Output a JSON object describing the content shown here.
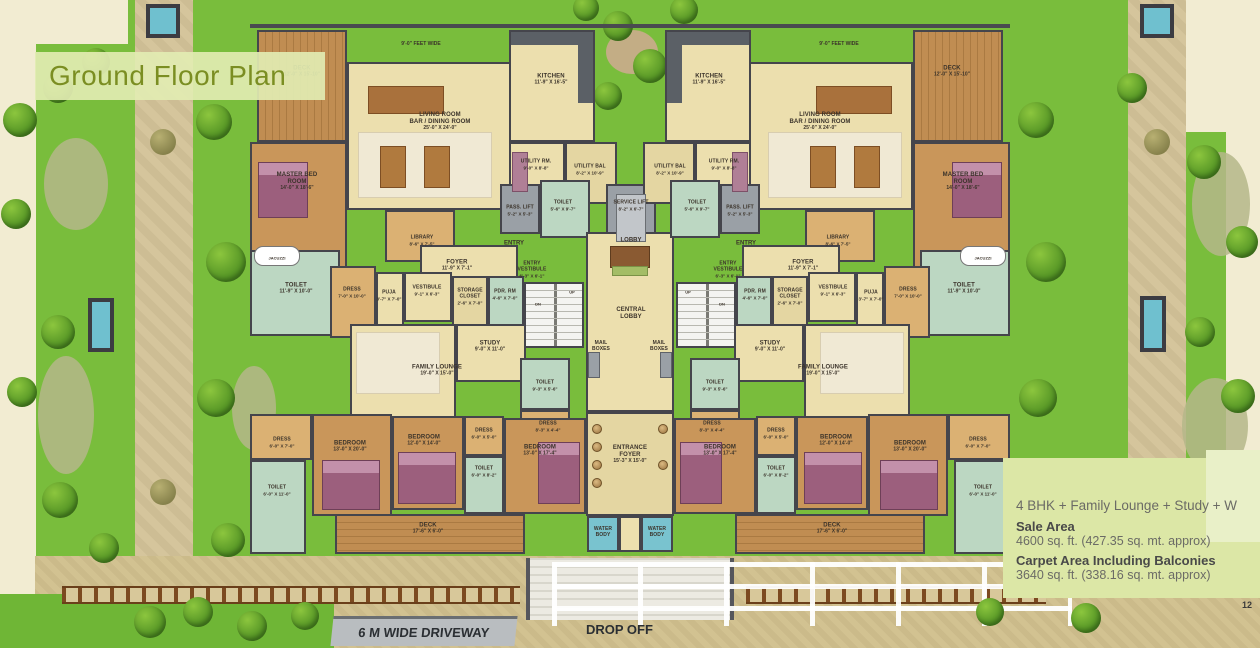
{
  "title": "Ground Floor Plan",
  "page_number": "12",
  "site": {
    "driveway": "6 M WIDE DRIVEWAY",
    "drop_off": "DROP OFF",
    "feet_wide": "9'-0\" FEET WIDE"
  },
  "info": {
    "configuration": "4 BHK + Family Lounge + Study + W",
    "sale_area_label": "Sale Area",
    "sale_area_value": "4600 sq. ft. (427.35 sq. mt. approx)",
    "carpet_area_label": "Carpet Area Including Balconies",
    "carpet_area_value": "3640 sq. ft. (338.16 sq. mt. approx)"
  },
  "rooms": {
    "kitchen": {
      "name": "KITCHEN",
      "dims": "11'-9\" X 16'-5\""
    },
    "living": {
      "line1": "LIVING ROOM",
      "line2": "BAR / DINING ROOM",
      "dims": "25'-0\" X 24'-0\""
    },
    "deck_top": {
      "name": "DECK",
      "dims": "12'-0\" X 15'-10\""
    },
    "deck_bottom": {
      "name": "DECK",
      "dims": "17'-6\" X 6'-0\""
    },
    "utility_rm": {
      "name": "UTILITY RM.",
      "dims": "9'-0\" X 8'-8\""
    },
    "utility_bal": {
      "name": "UTILITY BAL",
      "dims": "8'-2\" X 10'-9\""
    },
    "pass_lift": {
      "name": "PASS. LIFT",
      "dims": "5'-2\" X 5'-3\""
    },
    "service_lift": {
      "name": "SERVICE LIFT",
      "dims": "8'-2\" X 6'-7\""
    },
    "toilet_lift": {
      "name": "TOILET",
      "dims": "5'-6\" X 9'-7\""
    },
    "master_bed": {
      "line1": "MASTER BED",
      "line2": "ROOM",
      "dims": "14'-0\" X 18'-6\""
    },
    "library": {
      "name": "LIBRARY",
      "dims": "8'-6\" X 7'-5\""
    },
    "foyer": {
      "name": "FOYER",
      "dims": "11'-9\" X 7'-1\""
    },
    "entry_vestibule": {
      "line1": "ENTRY",
      "line2": "VESTIBULE",
      "dims": "6'-3\" X 6'-1\""
    },
    "entry": "ENTRY",
    "lobby": "LOBBY",
    "central_lobby": {
      "line1": "CENTRAL",
      "line2": "LOBBY"
    },
    "mail_boxes": {
      "line1": "MAIL",
      "line2": "BOXES"
    },
    "toilet_master": {
      "name": "TOILET",
      "dims": "11'-9\" X 10'-0\""
    },
    "dress_master": {
      "name": "DRESS",
      "dims": "7'-0\" X 10'-0\""
    },
    "puja": {
      "name": "PUJA",
      "dims": "3'-7\" X 7'-0\""
    },
    "vestibule": {
      "name": "VESTIBULE",
      "dims": "9'-1\" X 6'-3\""
    },
    "storage_closet": {
      "line1": "STORAGE",
      "line2": "CLOSET",
      "dims": "2'-6\" X 7'-0\""
    },
    "pdr_rm": {
      "name": "PDR. RM",
      "dims": "4'-6\" X 7'-0\""
    },
    "study": {
      "name": "STUDY",
      "dims": "9'-0\" X 11'-0\""
    },
    "family_lounge": {
      "name": "FAMILY LOUNGE",
      "dims": "19'-0\" X 15'-0\""
    },
    "toilet_family": {
      "name": "TOILET",
      "dims": "9'-3\" X 5'-6\""
    },
    "dress_family": {
      "name": "DRESS",
      "dims": "8'-3\" X 4'-4\""
    },
    "bedroom_13x20": {
      "name": "BEDROOM",
      "dims": "13'-0\" X 20'-0\""
    },
    "bedroom_12x14": {
      "name": "BEDROOM",
      "dims": "12'-0\" X 14'-0\""
    },
    "bedroom_13x17": {
      "name": "BEDROOM",
      "dims": "13'-0\" X 17'-4\""
    },
    "dress_6x7": {
      "name": "DRESS",
      "dims": "6'-0\" X 7'-0\""
    },
    "dress_6x5": {
      "name": "DRESS",
      "dims": "6'-0\" X 5'-0\""
    },
    "toilet_6x11": {
      "name": "TOILET",
      "dims": "6'-0\" X 11'-0\""
    },
    "toilet_6x8": {
      "name": "TOILET",
      "dims": "6'-0\" X 8'-2\""
    },
    "entrance_foyer": {
      "line1": "ENTRANCE",
      "line2": "FOYER",
      "dims": "15'-3\" X 15'-0\""
    },
    "water_body": {
      "line1": "WATER",
      "line2": "BODY"
    },
    "jacuzzi": "JACUZZI",
    "up": "UP",
    "dn": "DN"
  }
}
